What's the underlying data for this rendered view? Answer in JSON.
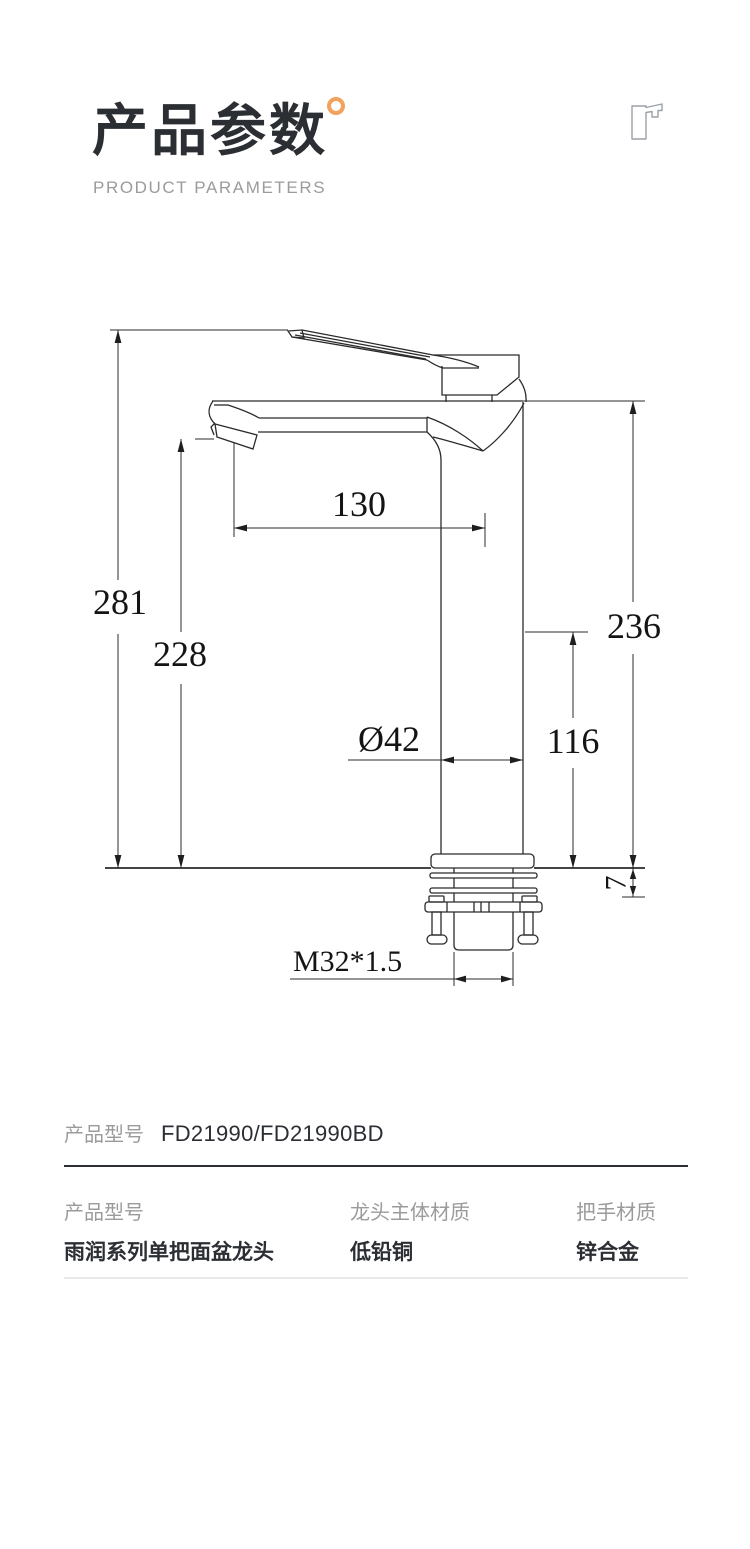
{
  "header": {
    "title": "产品参数",
    "subtitle": "PRODUCT PARAMETERS"
  },
  "drawing": {
    "dim_total_height": "281",
    "dim_spout_height": "228",
    "dim_spout_reach": "130",
    "dim_right_height": "236",
    "dim_body_height": "116",
    "dim_diameter": "Ø42",
    "dim_deck_thickness": "7",
    "dim_thread": "M32*1.5"
  },
  "model_row": {
    "label": "产品型号",
    "value": "FD21990/FD21990BD"
  },
  "specs": [
    {
      "label": "产品型号",
      "value": "雨润系列单把面盆龙头"
    },
    {
      "label": "龙头主体材质",
      "value": "低铅铜"
    },
    {
      "label": "把手材质",
      "value": "锌合金"
    }
  ],
  "colors": {
    "accent": "#F2A25C",
    "ink": "#2B2E33",
    "label_gray": "#9B9B9B",
    "line": "#2B2B2B"
  }
}
